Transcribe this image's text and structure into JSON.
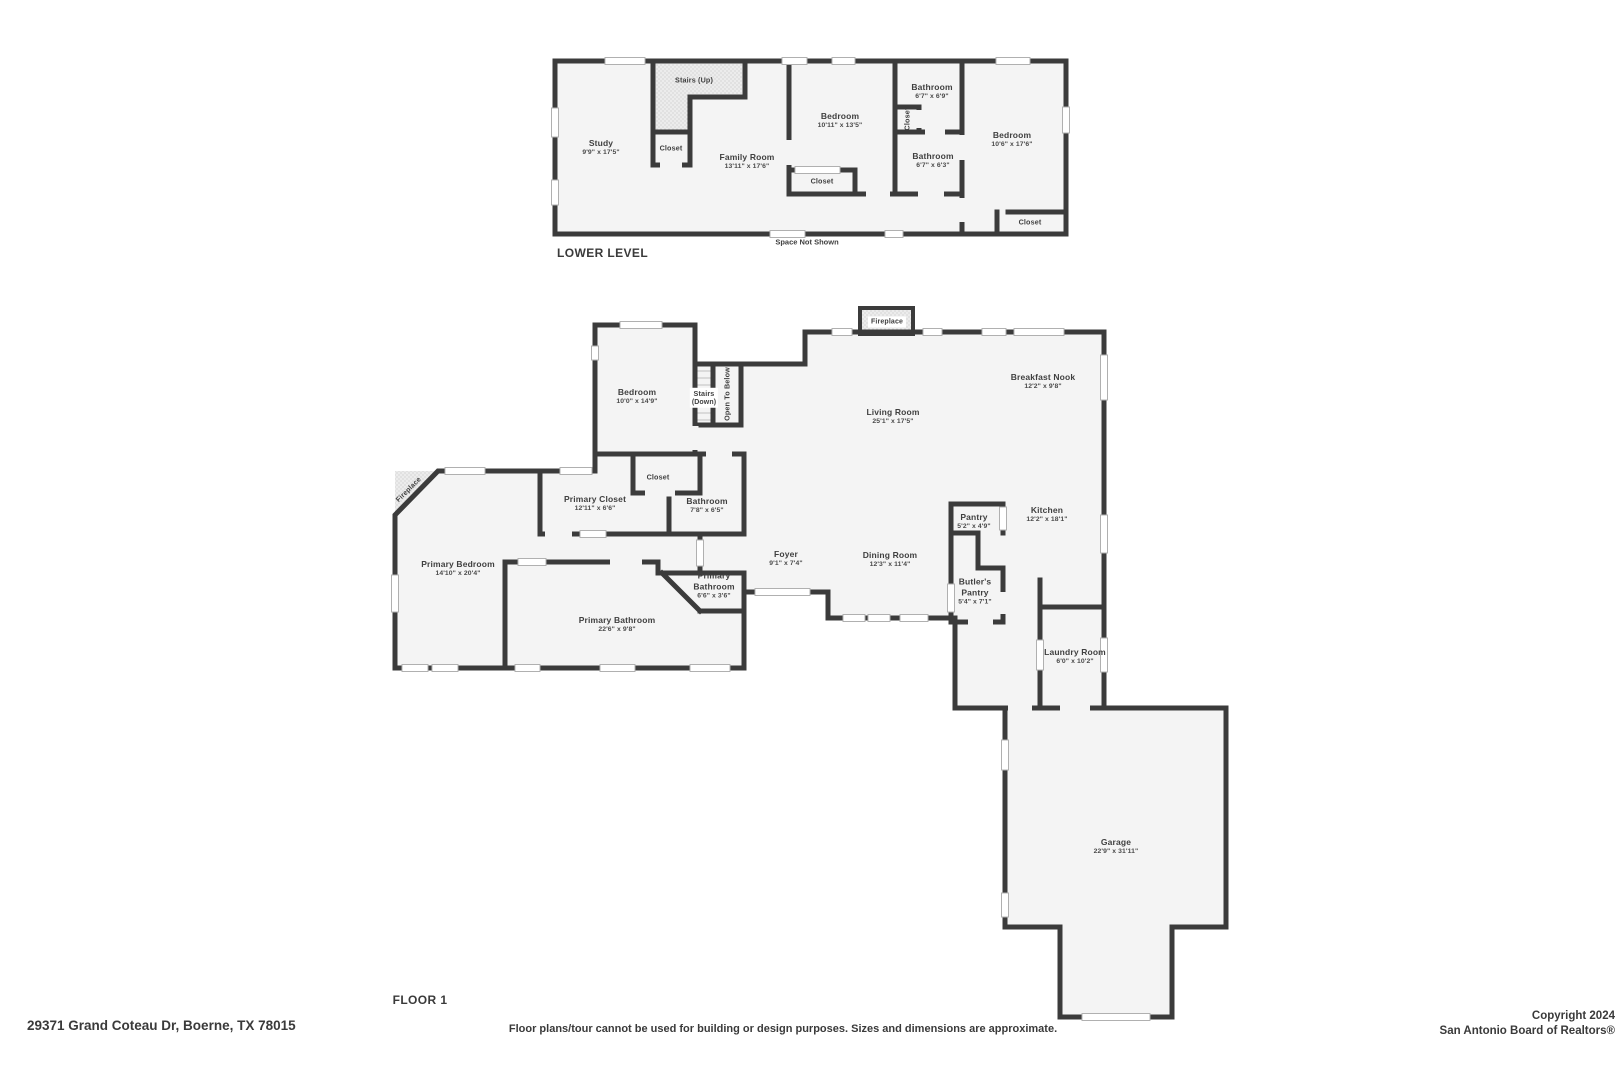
{
  "colors": {
    "wall": "#3b3b3b",
    "room_fill": "#f4f4f4",
    "window_line": "#b0b0b0",
    "background": "#ffffff"
  },
  "lower_level": {
    "title": "LOWER LEVEL",
    "note": "Space Not Shown",
    "rooms": {
      "study": {
        "name": "Study",
        "dims": "9'9\" x 17'5\""
      },
      "stairs_up": {
        "name": "Stairs (Up)"
      },
      "stairs_closet": {
        "name": "Closet"
      },
      "family_room": {
        "name": "Family Room",
        "dims": "13'11\" x 17'6\""
      },
      "bedroom_middle": {
        "name": "Bedroom",
        "dims": "10'11\" x 13'5\""
      },
      "bedroom_closet": {
        "name": "Closet"
      },
      "hall_closet": {
        "name": "Closet"
      },
      "bathroom_upper": {
        "name": "Bathroom",
        "dims": "6'7\" x 6'9\""
      },
      "bathroom_lower": {
        "name": "Bathroom",
        "dims": "6'7\" x 6'3\""
      },
      "bedroom_right": {
        "name": "Bedroom",
        "dims": "10'6\" x 17'6\""
      },
      "bedroom_right_closet": {
        "name": "Closet"
      }
    }
  },
  "floor_1": {
    "title": "FLOOR 1",
    "rooms": {
      "bedroom": {
        "name": "Bedroom",
        "dims": "10'0\" x 14'9\""
      },
      "stairs_down": {
        "name": "Stairs",
        "dims": "(Down)"
      },
      "open_to_below": {
        "name": "Open To Below"
      },
      "fireplace_living": {
        "name": "Fireplace"
      },
      "living_room": {
        "name": "Living Room",
        "dims": "25'1\" x 17'5\""
      },
      "breakfast_nook": {
        "name": "Breakfast Nook",
        "dims": "12'2\" x 9'8\""
      },
      "kitchen": {
        "name": "Kitchen",
        "dims": "12'2\" x 18'1\""
      },
      "pantry": {
        "name": "Pantry",
        "dims": "5'2\" x 4'9\""
      },
      "butlers_pantry": {
        "name": "Butler's Pantry",
        "dims": "5'4\" x 7'1\""
      },
      "dining_room": {
        "name": "Dining Room",
        "dims": "12'3\" x 11'4\""
      },
      "foyer": {
        "name": "Foyer",
        "dims": "9'1\" x 7'4\""
      },
      "hall_closet": {
        "name": "Closet"
      },
      "primary_closet": {
        "name": "Primary Closet",
        "dims": "12'11\" x 6'6\""
      },
      "bathroom": {
        "name": "Bathroom",
        "dims": "7'8\" x 6'5\""
      },
      "fireplace_primary": {
        "name": "Fireplace"
      },
      "primary_bedroom": {
        "name": "Primary Bedroom",
        "dims": "14'10\" x 20'4\""
      },
      "primary_bathroom_small": {
        "name": "Primary Bathroom",
        "dims": "6'6\" x 3'6\""
      },
      "primary_bathroom": {
        "name": "Primary Bathroom",
        "dims": "22'6\" x 9'8\""
      },
      "laundry_room": {
        "name": "Laundry Room",
        "dims": "6'0\" x 10'2\""
      },
      "garage": {
        "name": "Garage",
        "dims": "22'9\" x 31'11\""
      }
    }
  },
  "footer": {
    "address": "29371 Grand Coteau Dr, Boerne, TX 78015",
    "disclaimer": "Floor plans/tour cannot be used for building or design purposes. Sizes and dimensions are approximate.",
    "copyright_line1": "Copyright 2024",
    "copyright_line2": "San Antonio Board of Realtors®"
  }
}
